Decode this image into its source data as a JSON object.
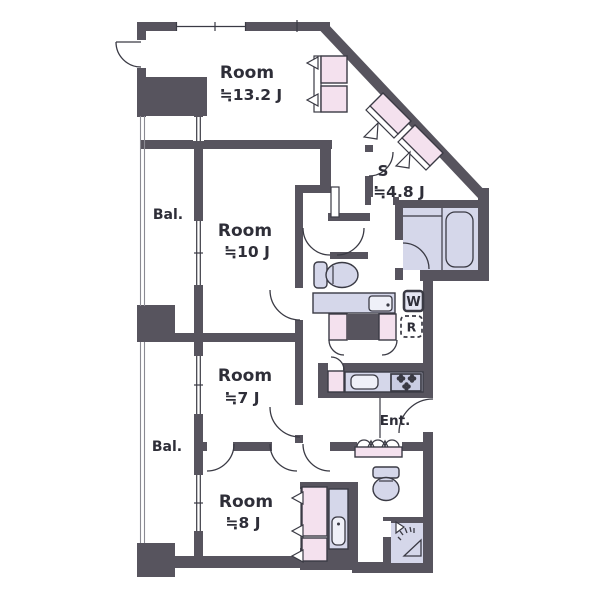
{
  "colors": {
    "wall": "#57545E",
    "line": "#3A3A44",
    "closet_pink": "#F4E1EE",
    "fixture_purple": "#D5D7EA",
    "text": "#2E2E38"
  },
  "labels": {
    "room13": {
      "name": "Room",
      "size": "≒13.2 J"
    },
    "room10": {
      "name": "Room",
      "size": "≒10 J"
    },
    "room7": {
      "name": "Room",
      "size": "≒7 J"
    },
    "room8": {
      "name": "Room",
      "size": "≒8 J"
    },
    "storage": {
      "name": "S",
      "size": "≒4.8 J"
    },
    "balcony_top": "Bal.",
    "balcony_bottom": "Bal.",
    "entrance": "Ent.",
    "washer": "W",
    "fridge": "R"
  }
}
